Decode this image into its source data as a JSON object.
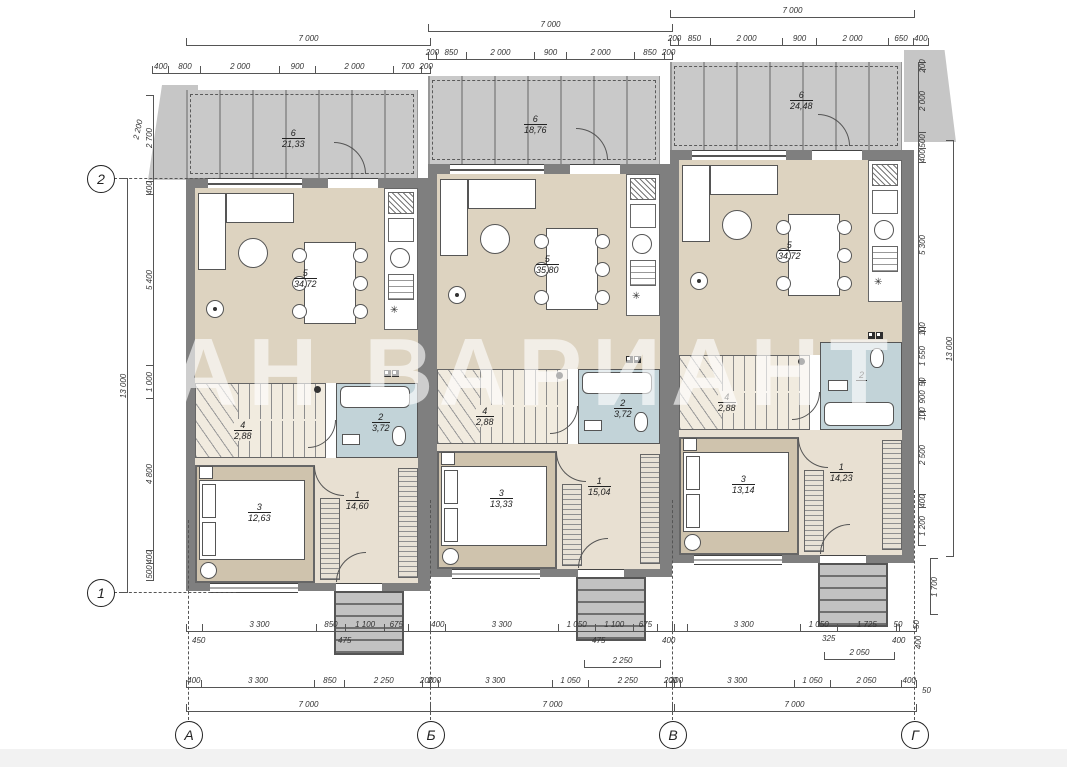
{
  "watermark": "АН ВАРИАНТ",
  "symbols": {
    "fridge": "✳"
  },
  "axes": {
    "r2": "2",
    "r1": "1",
    "cA": "А",
    "cB": "Б",
    "cV": "В",
    "cG": "Г"
  },
  "dims": {
    "ltot": "13 000",
    "lslant": "2 200",
    "left": [
      "2 700",
      "400",
      "5 400",
      "1 000",
      "4 800",
      "400",
      "500"
    ],
    "rtot": "13 000",
    "right": [
      "200",
      "2 000",
      "500",
      "400",
      "5 300",
      "100",
      "1 550",
      "50",
      "900",
      "100",
      "2 500",
      "400",
      "1 200"
    ],
    "rext": "1 700",
    "rs1": "50",
    "rs2": "400",
    "rs3": "50"
  },
  "units": [
    {
      "tt": "7 000",
      "ts": [
        "400",
        "800",
        "2 000",
        "900",
        "2 000",
        "700",
        "200"
      ],
      "ter": {
        "n": "6",
        "a": "21,33"
      },
      "liv": {
        "n": "5",
        "a": "34,72"
      },
      "st": {
        "n": "4",
        "a": "2,88"
      },
      "ba": {
        "n": "2",
        "a": "3,72"
      },
      "be": {
        "n": "3",
        "a": "12,63"
      },
      "ha": {
        "n": "1",
        "a": "14,60"
      },
      "b1": [
        "",
        "3 300",
        "850",
        "1 100",
        "675",
        ""
      ],
      "b2": [
        "400",
        "3 300",
        "850",
        "2 250",
        "200"
      ],
      "bt": "7 000",
      "s1": "450",
      "s2": "475",
      "mid": ""
    },
    {
      "tt": "7 000",
      "ts": [
        "200",
        "850",
        "2 000",
        "900",
        "2 000",
        "850",
        "200"
      ],
      "ter": {
        "n": "6",
        "a": "18,76"
      },
      "liv": {
        "n": "5",
        "a": "35,80"
      },
      "st": {
        "n": "4",
        "a": "2,88"
      },
      "ba": {
        "n": "2",
        "a": "3,72"
      },
      "be": {
        "n": "3",
        "a": "13,33"
      },
      "ha": {
        "n": "1",
        "a": "15,04"
      },
      "b1": [
        "400",
        "3 300",
        "1 050",
        "1 100",
        "675",
        ""
      ],
      "b2": [
        "200",
        "3 300",
        "1 050",
        "2 250",
        "200"
      ],
      "bt": "7 000",
      "s1": "475",
      "s2": "400",
      "mid": "2 250"
    },
    {
      "tt": "7 000",
      "ts": [
        "200",
        "850",
        "2 000",
        "900",
        "2 000",
        "650",
        "400"
      ],
      "ter": {
        "n": "6",
        "a": "24,48"
      },
      "liv": {
        "n": "5",
        "a": "34,72"
      },
      "st": {
        "n": "4",
        "a": "2,88"
      },
      "ba": {
        "n": "2",
        "a": ""
      },
      "be": {
        "n": "3",
        "a": "13,14"
      },
      "ha": {
        "n": "1",
        "a": "14,23"
      },
      "b1": [
        "",
        "3 300",
        "1 050",
        "1 725",
        "50",
        ""
      ],
      "b2": [
        "200",
        "3 300",
        "1 050",
        "2 050",
        "400"
      ],
      "bt": "7 000",
      "s1": "325",
      "s2": "400",
      "mid": "2 050"
    }
  ]
}
